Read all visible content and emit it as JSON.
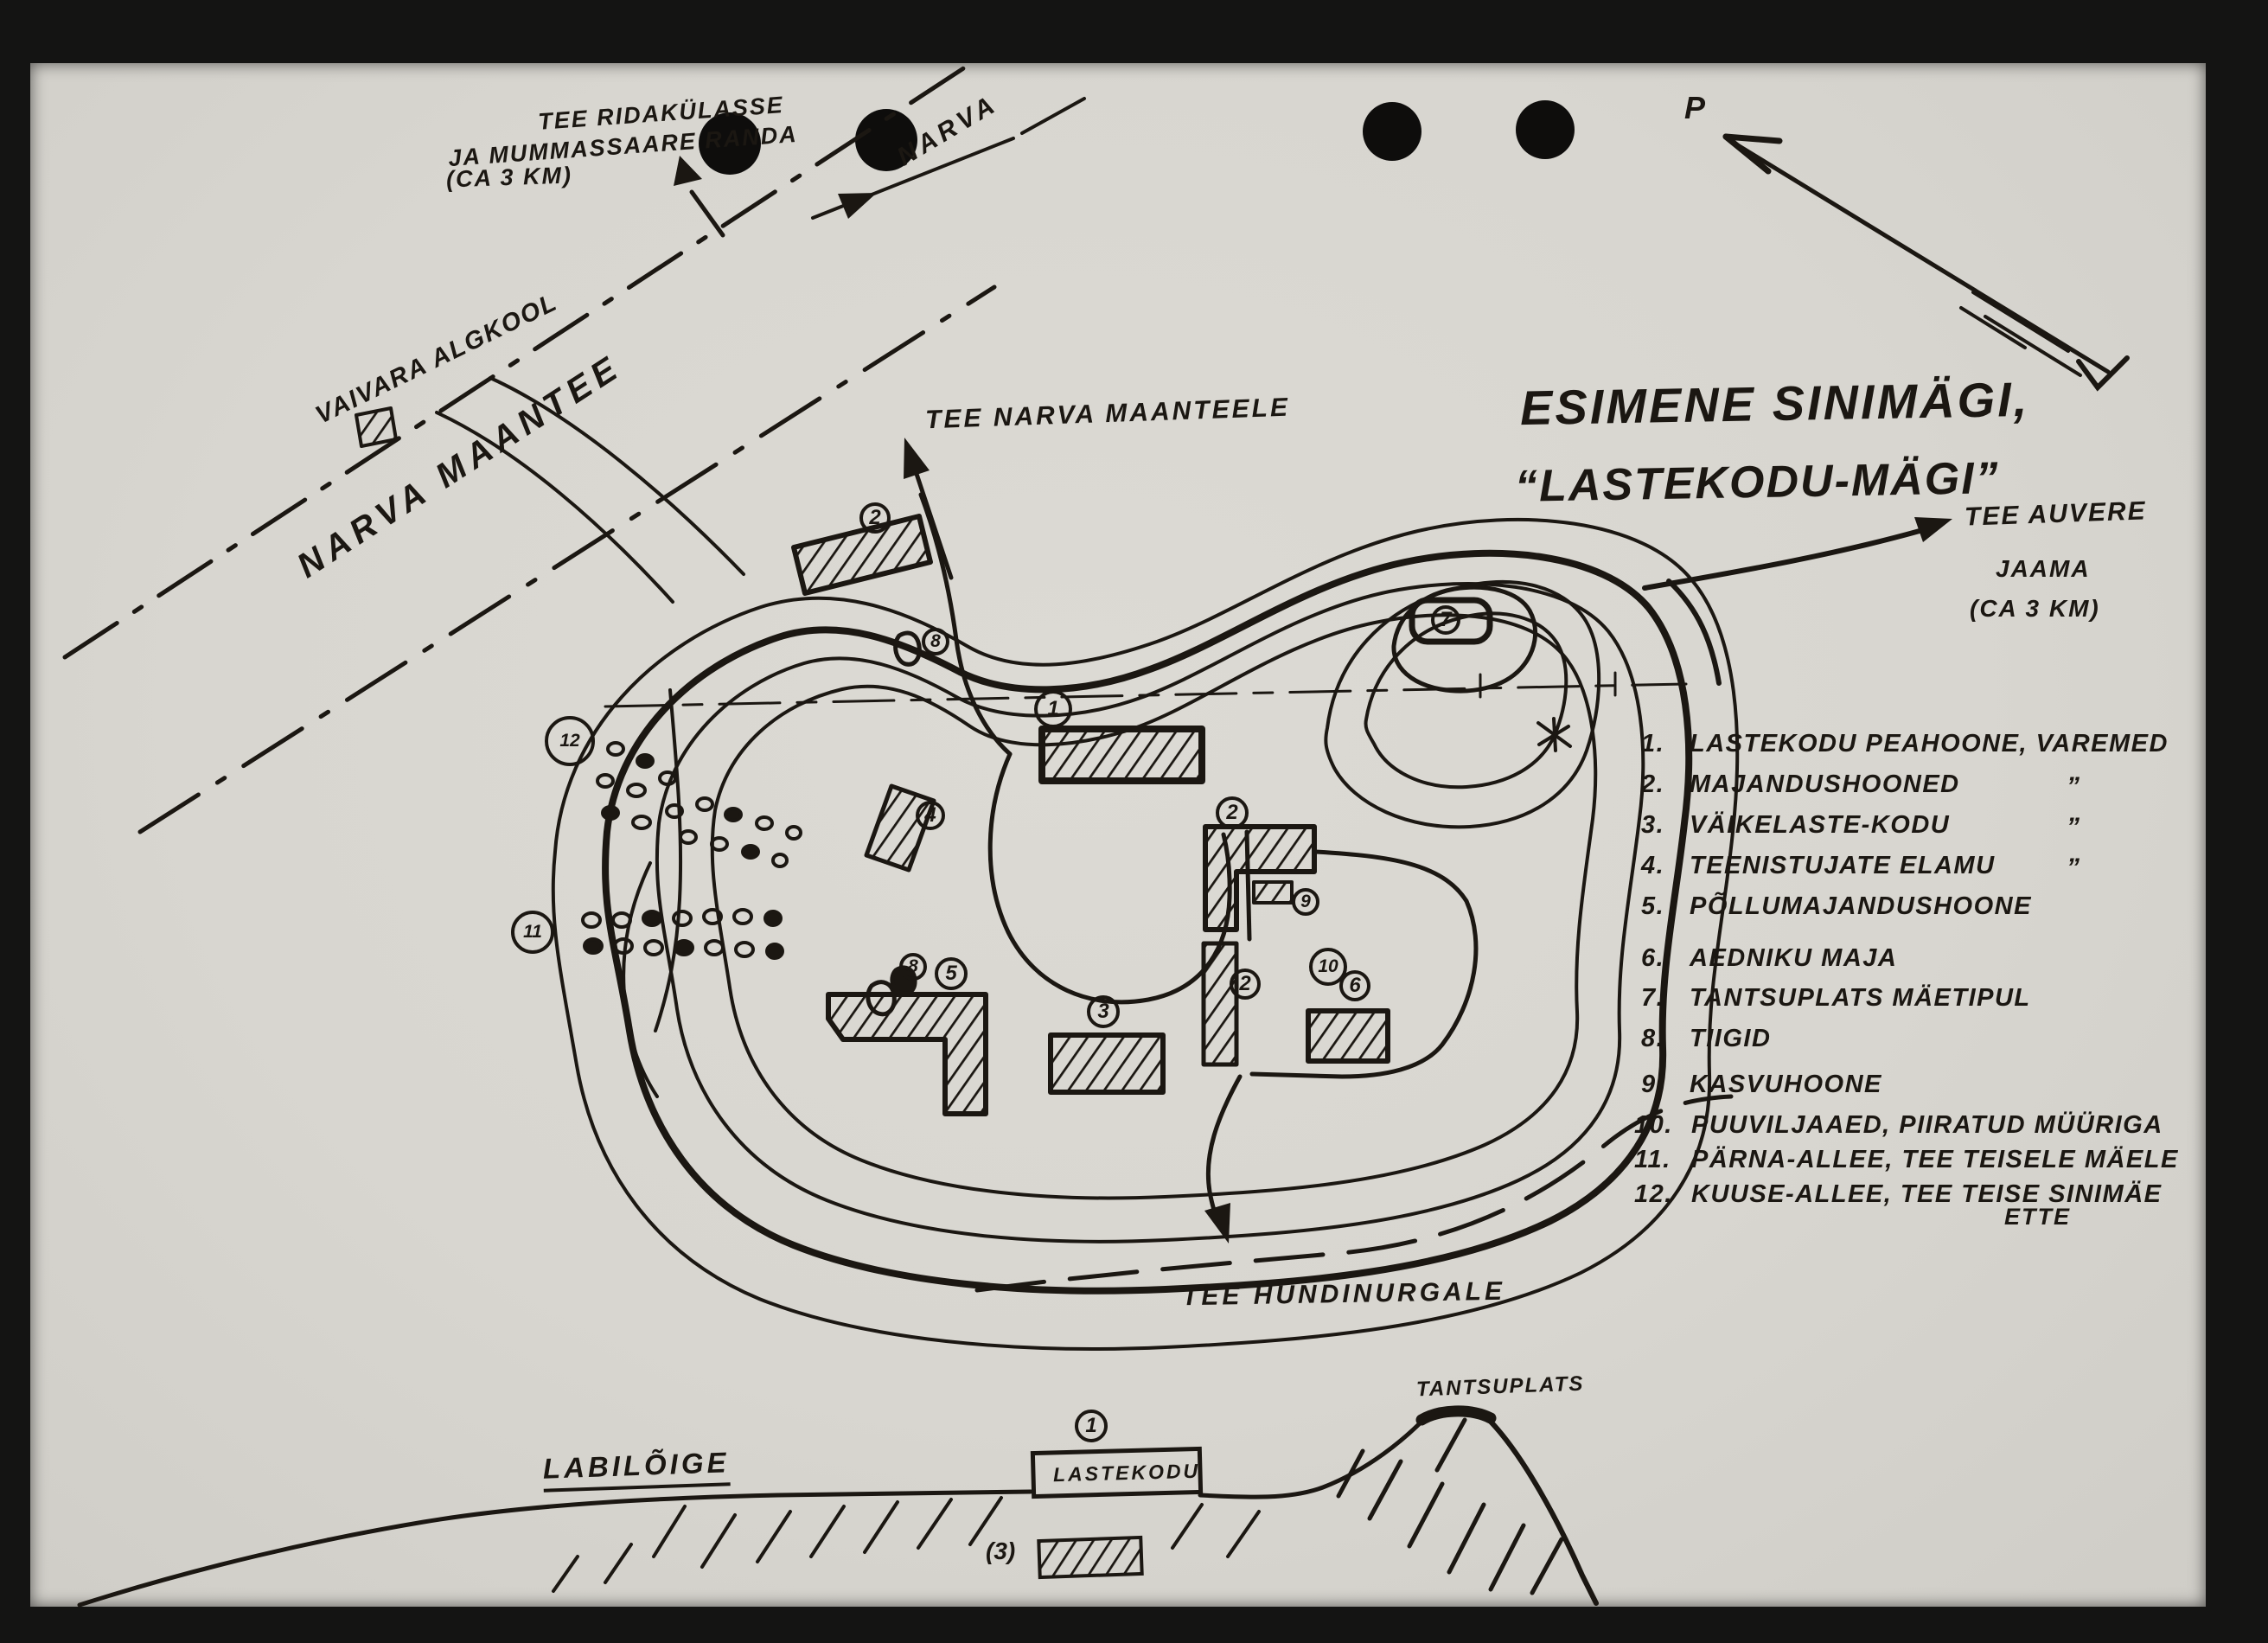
{
  "photo": {
    "background_color": "#141413",
    "paper_color": "#d8d6d0",
    "ink_color": "#1b1712"
  },
  "annotations": {
    "ridakyla_line1": "TEE RIDAKÜLASSE",
    "ridakyla_line2": "JA MUMMASSAARE RANDA",
    "ridakyla_line3": "(CA 3 KM)",
    "narva_direction": "NARVA",
    "vaivara_school": "VAIVARA ALGKOOL",
    "narva_maantee": "NARVA MAANTEE",
    "north_mark": "P",
    "tee_narva_maanteele": "TEE NARVA MAANTEELE",
    "tee_auvere_line1": "TEE AUVERE",
    "tee_auvere_line2": "JAAMA",
    "tee_auvere_line3": "(CA 3 KM)",
    "tee_hundinurgale": "TEE HUNDINURGALE"
  },
  "title": {
    "line1": "ESIMENE SINIMÄGI,",
    "line2": "“LASTEKODU-MÄGI”"
  },
  "legend": {
    "items": [
      {
        "num": "1.",
        "label": "LASTEKODU PEAHOONE, VAREMED",
        "ditto": ""
      },
      {
        "num": "2.",
        "label": "MAJANDUSHOONED",
        "ditto": "”"
      },
      {
        "num": "3.",
        "label": "VÄIKELASTE-KODU",
        "ditto": "”"
      },
      {
        "num": "4.",
        "label": "TEENISTUJATE ELAMU",
        "ditto": "”"
      },
      {
        "num": "5.",
        "label": "PÕLLUMAJANDUSHOONE",
        "ditto": ""
      },
      {
        "num": "6.",
        "label": "AEDNIKU MAJA",
        "ditto": ""
      },
      {
        "num": "7.",
        "label": "TANTSUPLATS MÄETIPUL",
        "ditto": ""
      },
      {
        "num": "8.",
        "label": "TIIGID",
        "ditto": ""
      },
      {
        "num": "9.",
        "label": "KASVUHOONE",
        "ditto": ""
      },
      {
        "num": "10.",
        "label": "PUUVILJAAED, PIIRATUD MÜÜRIGA",
        "ditto": ""
      },
      {
        "num": "11.",
        "label": "PÄRNA-ALLEE, TEE TEISELE MÄELE",
        "ditto": ""
      },
      {
        "num": "12.",
        "label": "KUUSE-ALLEE, TEE TEISE SINIMÄE",
        "ditto": ""
      }
    ],
    "item12_continuation": "ETTE"
  },
  "map_markers": {
    "m1": "1",
    "m2_top": "2",
    "m2_mid": "2",
    "m2_low": "2",
    "m3": "3",
    "m4": "4",
    "m5": "5",
    "m6": "6",
    "m7": "7",
    "m8_top": "8",
    "m8_low": "8",
    "m9": "9",
    "m10": "10",
    "m11": "11",
    "m12": "12"
  },
  "cross_section": {
    "heading": "LABILÕIGE",
    "peak_label": "TANTSUPLATS",
    "building_label": "LASTEKODU",
    "building_marker": "1",
    "slope_marker": "(3)"
  }
}
